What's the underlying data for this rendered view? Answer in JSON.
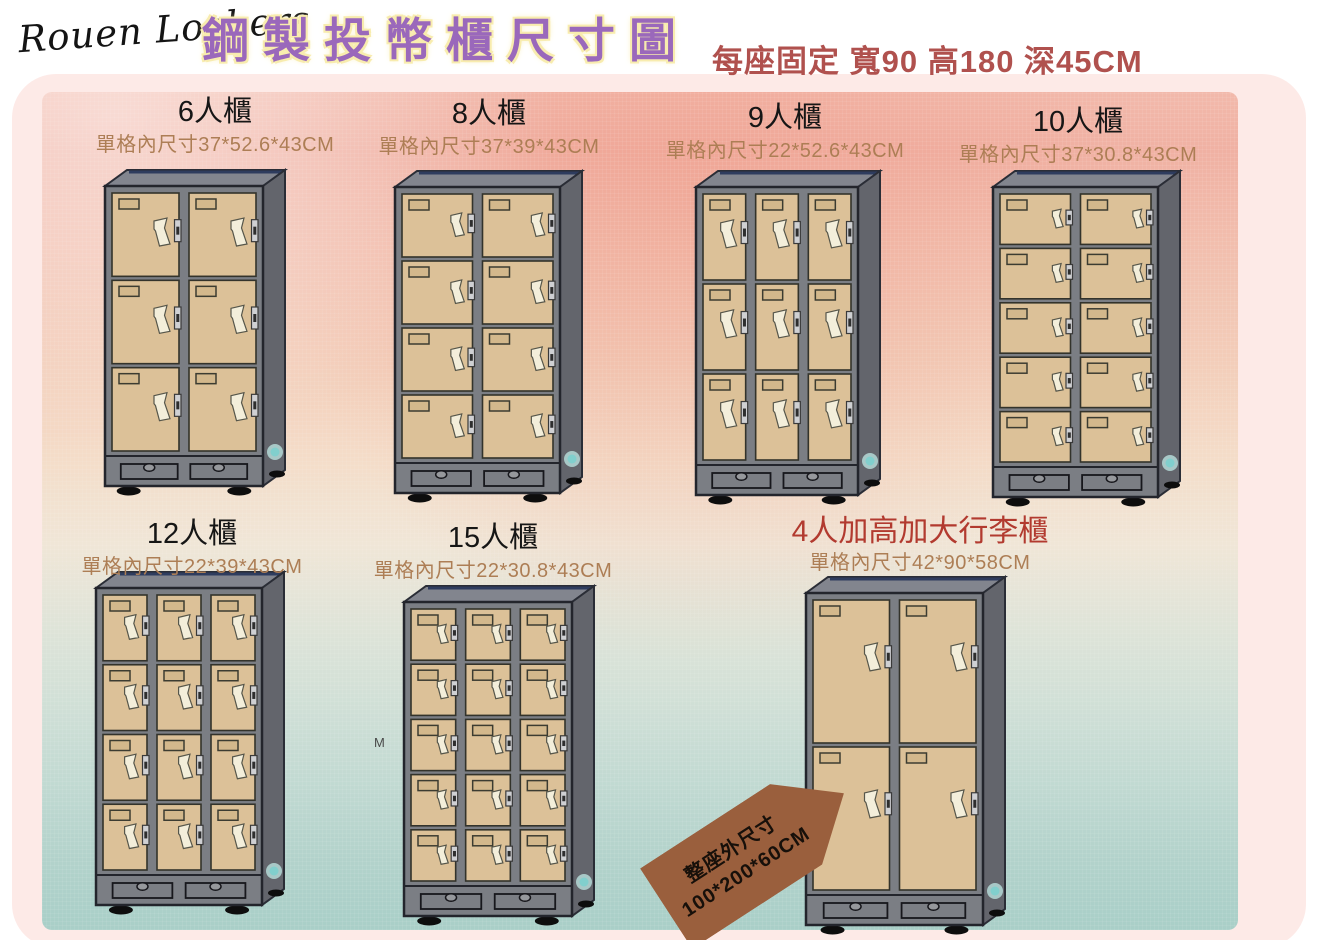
{
  "header": {
    "brand": "Rouen Lockers",
    "title": "鋼製投幣櫃尺寸圖",
    "subtitle": "每座固定 寬90 高180 深45CM"
  },
  "lockers": [
    {
      "id": "locker-6",
      "title": "6人櫃",
      "dims": "單格內尺寸37*52.6*43CM",
      "rows": 3,
      "cols": 2,
      "doors": 6
    },
    {
      "id": "locker-8",
      "title": "8人櫃",
      "dims": "單格內尺寸37*39*43CM",
      "rows": 4,
      "cols": 2,
      "doors": 8
    },
    {
      "id": "locker-9",
      "title": "9人櫃",
      "dims": "單格內尺寸22*52.6*43CM",
      "rows": 3,
      "cols": 3,
      "doors": 9
    },
    {
      "id": "locker-10",
      "title": "10人櫃",
      "dims": "單格內尺寸37*30.8*43CM",
      "rows": 5,
      "cols": 2,
      "doors": 10
    },
    {
      "id": "locker-12",
      "title": "12人櫃",
      "dims": "單格內尺寸22*39*43CM",
      "rows": 4,
      "cols": 3,
      "doors": 12
    },
    {
      "id": "locker-15",
      "title": "15人櫃",
      "dims": "單格內尺寸22*30.8*43CM",
      "rows": 5,
      "cols": 3,
      "doors": 15
    },
    {
      "id": "locker-4-luggage",
      "title": "4人加高加大行李櫃",
      "dims": "單格內尺寸42*90*58CM",
      "rows": 2,
      "cols": 2,
      "doors": 4
    }
  ],
  "size_tag": {
    "line1": "整座外尺寸",
    "line2": "100*200*60CM"
  },
  "watermark": "M",
  "colors": {
    "title_purple": "#9a68bb",
    "title_glow_yellow": "#f8ecae",
    "subtitle_red": "#b0514e",
    "luggage_title_red": "#b23a2f",
    "dims_brown": "#ad7e55",
    "tag_brown": "#9a5f3d",
    "door_tan": "#dcc198",
    "cabinet_gray": "#7b7e84",
    "cabinet_side_gray": "#63656c",
    "bg_pink": "#f0b1a3",
    "bg_teal": "#a9cfc8",
    "frame_pink": "#fdeae7",
    "brand_dot_teal": "#7ed0ce"
  }
}
